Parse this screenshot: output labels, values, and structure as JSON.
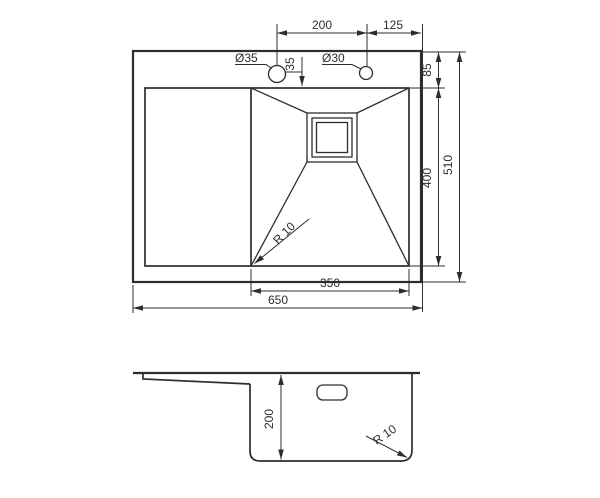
{
  "meta": {
    "background_color": "#ffffff",
    "line_color": "#2d2d2d",
    "drawing_type": "kitchen sink dimensional drawing"
  },
  "top_view": {
    "dims": {
      "hole_spacing": "200",
      "hole_to_right_edge": "125",
      "top_edge_to_bowl": "85",
      "hole_to_bowl": "35",
      "bowl_width": "350",
      "bowl_depth": "400",
      "overall_width": "650",
      "overall_depth": "510"
    },
    "labels": {
      "hole_large": "Ø35",
      "hole_small": "Ø30",
      "corner_radius": "R 10"
    }
  },
  "section_view": {
    "dims": {
      "bowl_depth": "200"
    },
    "labels": {
      "bottom_radius": "R 10"
    }
  }
}
